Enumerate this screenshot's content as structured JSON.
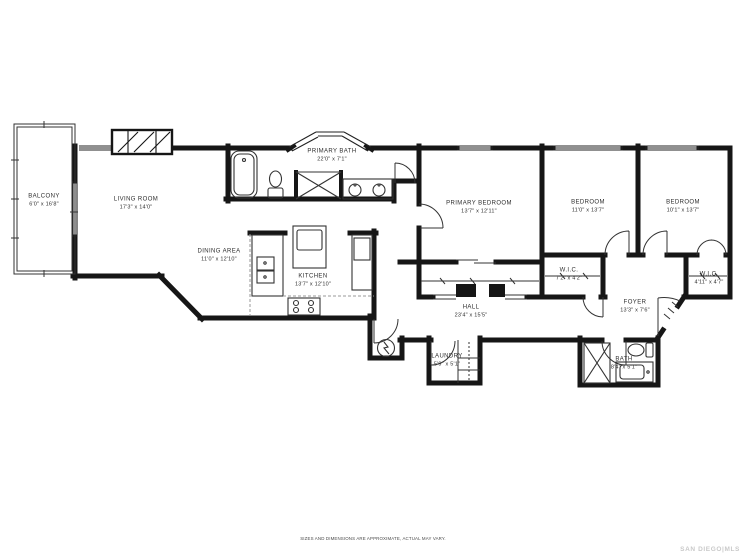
{
  "floorplan": {
    "rooms": {
      "balcony": {
        "label": "BALCONY",
        "dims": "6'0\" x 16'8\""
      },
      "living_room": {
        "label": "LIVING ROOM",
        "dims": "17'3\" x 14'0\""
      },
      "dining_area": {
        "label": "DINING AREA",
        "dims": "11'0\" x 12'10\""
      },
      "kitchen": {
        "label": "KITCHEN",
        "dims": "13'7\" x 12'10\""
      },
      "primary_bath": {
        "label": "PRIMARY BATH",
        "dims": "22'0\" x 7'1\""
      },
      "primary_bedroom": {
        "label": "PRIMARY BEDROOM",
        "dims": "13'7\" x 12'11\""
      },
      "bedroom_2": {
        "label": "BEDROOM",
        "dims": "11'0\" x 13'7\""
      },
      "bedroom_3": {
        "label": "BEDROOM",
        "dims": "10'1\" x 13'7\""
      },
      "wic_1": {
        "label": "W.I.C.",
        "dims": "7'2\" x 4'2\""
      },
      "wic_2": {
        "label": "W.I.C.",
        "dims": "4'11\" x 4'7\""
      },
      "foyer": {
        "label": "FOYER",
        "dims": "13'3\" x 7'6\""
      },
      "hall": {
        "label": "HALL",
        "dims": "23'4\" x 15'5\""
      },
      "laundry": {
        "label": "LAUNDRY",
        "dims": "5'9\" x 5'1\""
      },
      "bath": {
        "label": "BATH",
        "dims": "8'4\" x 5'1\""
      }
    },
    "disclaimer": "SIZES AND DIMENSIONS ARE APPROXIMATE, ACTUAL MAY VARY.",
    "brand": "SAN DIEGO|MLS",
    "colors": {
      "wall": "#161616",
      "label_text": "#2e2e2e",
      "brand_text": "#c9c9c9"
    }
  }
}
